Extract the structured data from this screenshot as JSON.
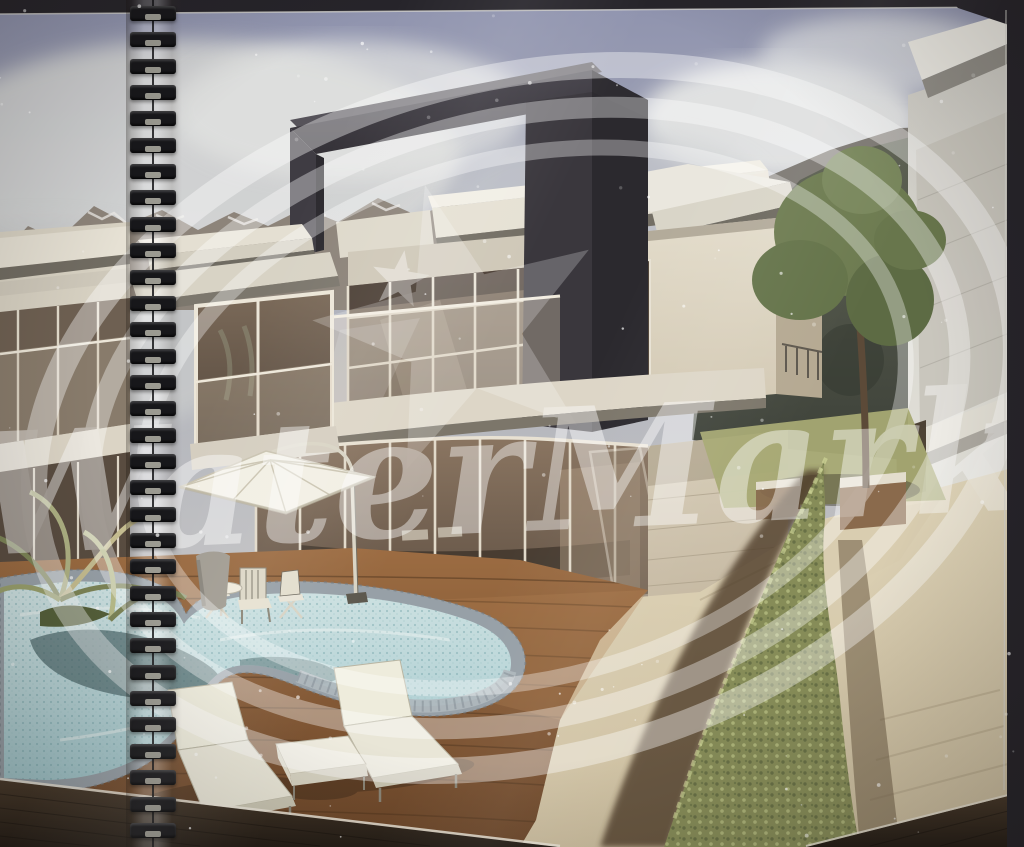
{
  "photo": {
    "kind": "photograph of a spiral-bound brochure page",
    "subject": "3D architectural rendering of a modern two-storey villa with kidney-shaped pool, wooden sun deck, two loungers, cantilever parasol, bistro chairs, clipped hedge, neighbouring villas and snow-capped mountains",
    "watermark": {
      "text": "WaterMark"
    },
    "binding": {
      "side": "left",
      "coil_count": 32
    },
    "scene_counts": {
      "sun_loungers": 2,
      "parasols": 1,
      "bistro_chairs": 3,
      "villas_visible": 3
    },
    "palette": {
      "photo_background": "#232125",
      "page_border": "#26242a",
      "binding_coil": "#17171a",
      "sky_top": "#8f93ae",
      "sky_light": "#c6c5c4",
      "cloud": "#e2e3e1",
      "mountain_rock": "#8a8177",
      "snow": "#eceae6",
      "forest_dark": "#3c4038",
      "wall_cream": "#d8d2c3",
      "wall_white": "#edebe2",
      "frame_dark": "#3a373d",
      "glass_dark": "#6b5b4c",
      "deck_wood": "#8a5c38",
      "pool_water": "#b9d6d8",
      "pool_rim": "#97a0a7",
      "pool_shadow": "#4c676a",
      "hedge_green": "#868c58",
      "lawn": "#a6a973",
      "path_stone": "#d9cdb0",
      "lounger_white": "#eeecdc",
      "parasol_white": "#f2efe4",
      "wicker_dark": "#322a20",
      "watermark": "#ffffff"
    }
  }
}
